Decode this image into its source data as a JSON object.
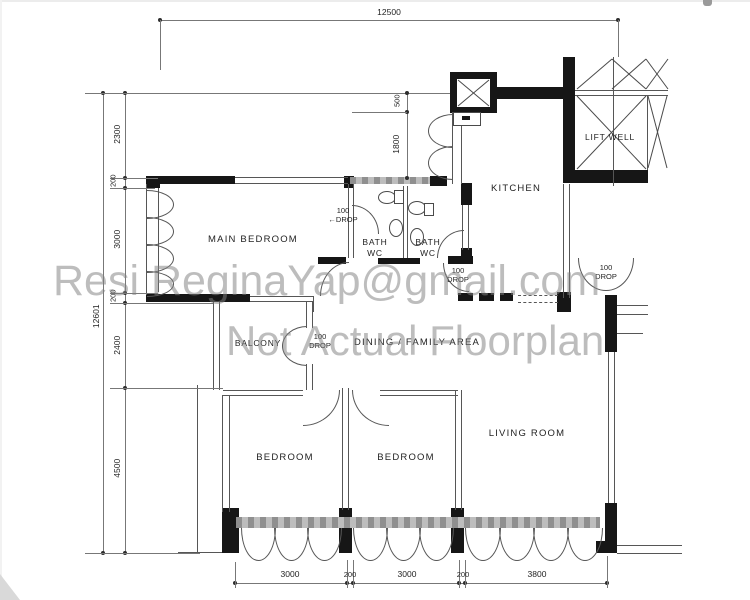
{
  "watermark": {
    "line1": "Resi ReginaYap@gmail.com",
    "line2": "Not Actual Floorplan"
  },
  "rooms": {
    "main_bedroom": "MAIN BEDROOM",
    "bath1": {
      "line1": "BATH",
      "line2": "WC"
    },
    "bath2": {
      "line1": "BATH",
      "line2": "WC"
    },
    "kitchen": "KITCHEN",
    "lift_well": "LIFT WELL",
    "balcony": "BALCONY",
    "dining": "DINING / FAMILY AREA",
    "bedroom_left": "BEDROOM",
    "bedroom_middle": "BEDROOM",
    "living_room": "LIVING ROOM"
  },
  "dimensions": {
    "top_width": "12500",
    "left_total": "12601",
    "left_segments": [
      "2300",
      "200",
      "3000",
      "200",
      "2400",
      "4500"
    ],
    "shaft_offset": "500",
    "bath_zone_height": "1800",
    "bottom_segments": [
      "3000",
      "200",
      "3000",
      "200",
      "3800"
    ]
  },
  "drops": {
    "bedroom": {
      "arrow": "←",
      "value": "100",
      "label": "DROP"
    },
    "dining": {
      "value": "100",
      "label": "DROP"
    },
    "entrance": {
      "value": "100",
      "label": "DROP"
    },
    "balcony": {
      "value": "100",
      "label": "DROP"
    }
  },
  "colors": {
    "wall": "#161616",
    "line": "#565656",
    "watermark": "#808080"
  }
}
